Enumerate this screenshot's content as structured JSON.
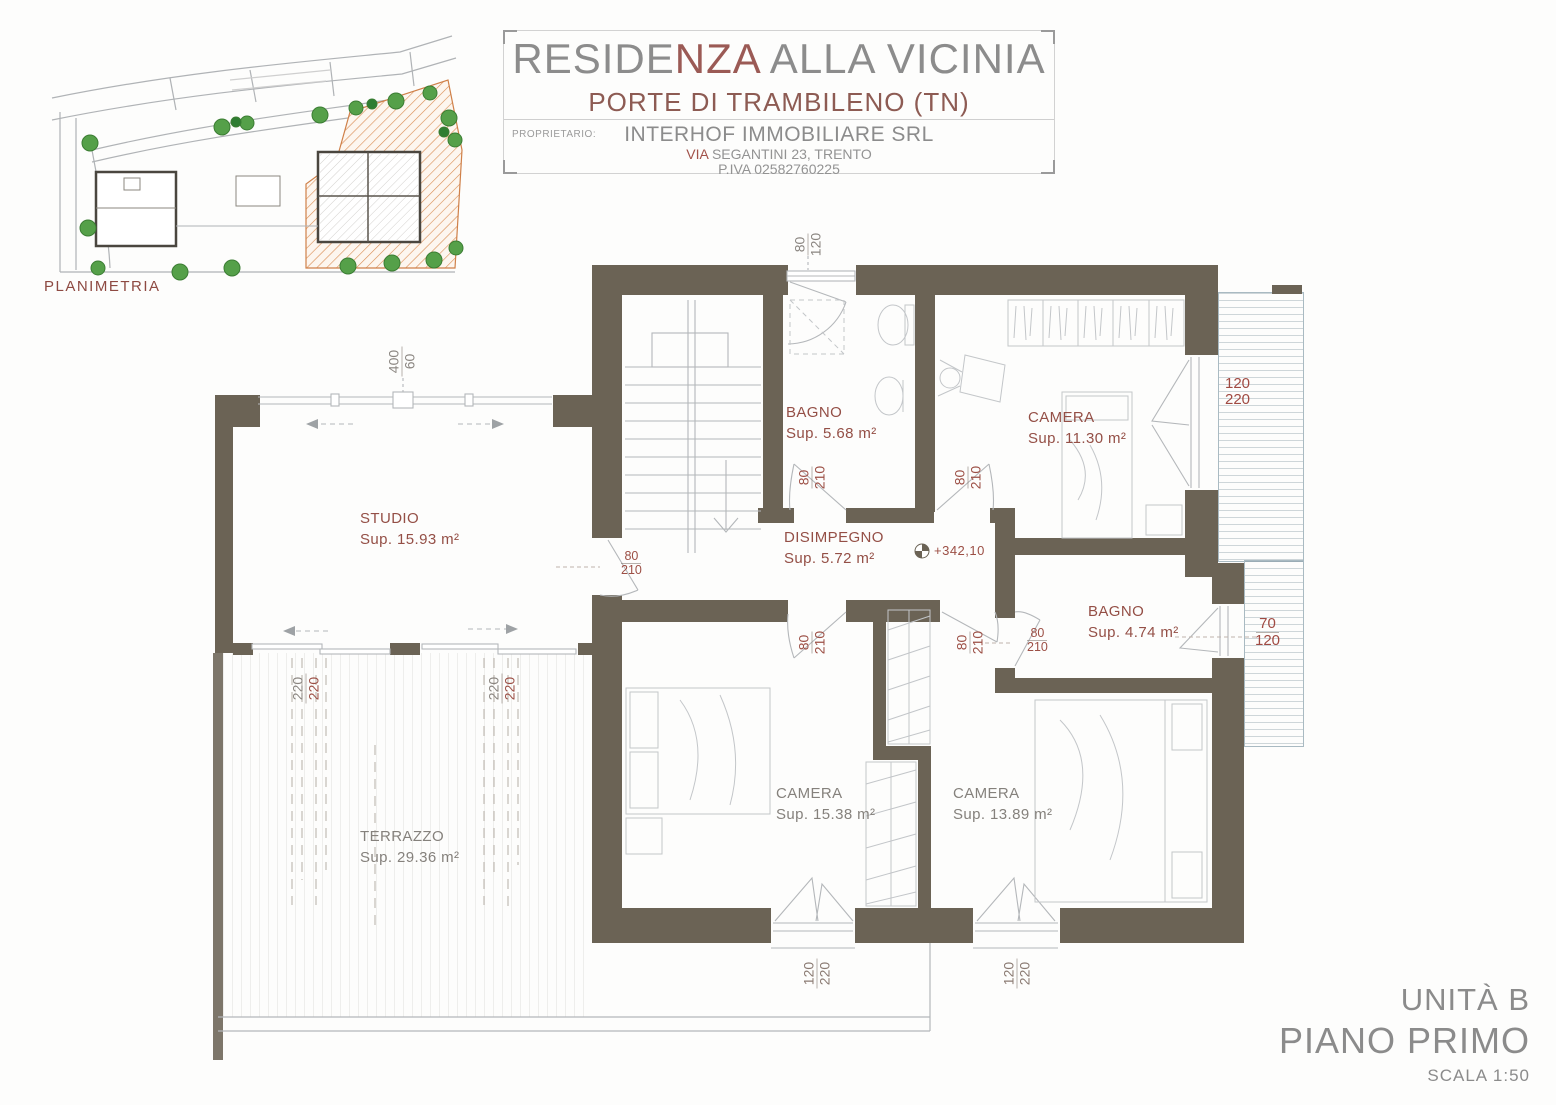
{
  "title_block": {
    "line1_pre": "RESIDE",
    "line1_accent": "NZA",
    "line1_rest": " ALLA VICINIA",
    "line2": "PORTE DI TRAMBILENO (TN)",
    "owner_label": "PROPRIETARIO:",
    "owner_name": "INTERHOF IMMOBILIARE SRL",
    "address_accent": "VIA",
    "address_rest": " SEGANTINI 23, TRENTO",
    "piva": "P.IVA 02582760225"
  },
  "site_plan": {
    "label": "PLANIMETRIA"
  },
  "rooms": {
    "bagno1": {
      "name": "BAGNO",
      "area": "Sup. 5.68 m²"
    },
    "camera1": {
      "name": "CAMERA",
      "area": "Sup. 11.30 m²"
    },
    "disimpegno": {
      "name": "DISIMPEGNO",
      "area": "Sup. 5.72 m²"
    },
    "bagno2": {
      "name": "BAGNO",
      "area": "Sup. 4.74 m²"
    },
    "camera2": {
      "name": "CAMERA",
      "area": "Sup. 15.38 m²"
    },
    "camera3": {
      "name": "CAMERA",
      "area": "Sup. 13.89 m²"
    },
    "studio": {
      "name": "STUDIO",
      "area": "Sup. 15.93 m²"
    },
    "terrazzo": {
      "name": "TERRAZZO",
      "area": "Sup. 29.36 m²"
    }
  },
  "dims": {
    "win_top": {
      "w": "80",
      "h": "120"
    },
    "win_studio": {
      "w": "400",
      "h": "60"
    },
    "balcony_win": {
      "w": "120",
      "h": "220"
    },
    "bagno2_win": {
      "w": "70",
      "h": "120"
    },
    "slider": {
      "w": "220",
      "h": "220"
    },
    "cam_win": {
      "w": "120",
      "h": "220"
    },
    "door": {
      "w": "80",
      "h": "210"
    }
  },
  "elevation": {
    "value": "+342,10"
  },
  "footer": {
    "unit": "UNITÀ B",
    "floor": "PIANO PRIMO",
    "scale": "SCALA 1:50"
  },
  "colors": {
    "wall": "#6b6355",
    "room_label_red": "#944f46",
    "room_label_gray": "#85817c",
    "dim_red": "#9c4f45",
    "dim_gray": "#8a8580",
    "title_gray": "#8c8c8c",
    "title_red": "#8d5b53",
    "line_gray": "#b4b7ba",
    "balcony_line": "#a9bac2",
    "site_green": "#55a049",
    "site_orange": "#cf8049"
  }
}
